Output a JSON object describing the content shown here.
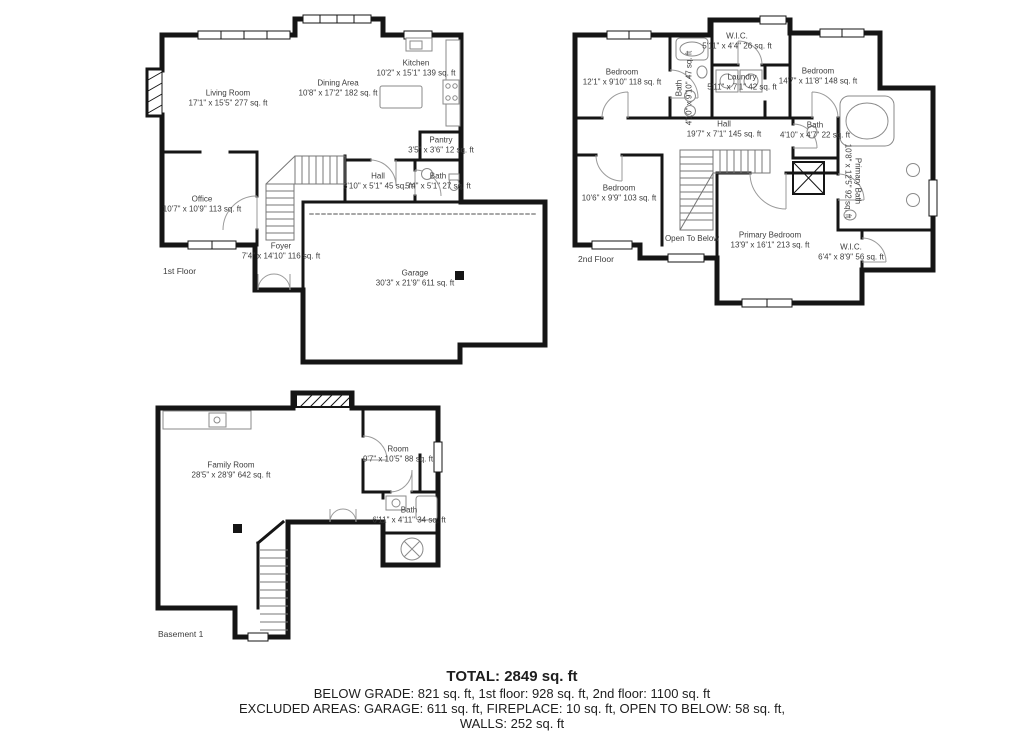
{
  "page": {
    "background": "#ffffff",
    "wall_color": "#151515",
    "label_color": "#3d3d3d"
  },
  "floors": [
    {
      "label": "1st Floor",
      "rooms": [
        {
          "name": "Living Room",
          "dims": "17'1\" x 15'5\" 277 sq. ft"
        },
        {
          "name": "Dining Area",
          "dims": "10'8\" x 17'2\" 182 sq. ft"
        },
        {
          "name": "Kitchen",
          "dims": "10'2\" x 15'1\" 139 sq. ft"
        },
        {
          "name": "Pantry",
          "dims": "3'5\" x 3'6\" 12 sq. ft"
        },
        {
          "name": "Hall",
          "dims": "8'10\" x 5'1\" 45 sq. ft"
        },
        {
          "name": "Bath",
          "dims": "5'4\" x 5'1\" 27 sq. ft"
        },
        {
          "name": "Office",
          "dims": "10'7\" x 10'9\" 113 sq. ft"
        },
        {
          "name": "Foyer",
          "dims": "7'4\" x 14'10\" 116 sq. ft"
        },
        {
          "name": "Garage",
          "dims": "30'3\" x 21'9\" 611 sq. ft"
        }
      ]
    },
    {
      "label": "2nd Floor",
      "rooms": [
        {
          "name": "Bedroom",
          "dims": "12'1\" x 9'10\" 118 sq. ft"
        },
        {
          "name": "W.I.C.",
          "dims": "5'11\" x 4'4\" 26 sq. ft"
        },
        {
          "name": "Laundry",
          "dims": "5'11\" x 7'1\" 42 sq. ft"
        },
        {
          "name": "Bedroom",
          "dims": "14'7\" x 11'8\" 148 sq. ft"
        },
        {
          "name": "Bath",
          "dims": "4'10\" x 9'10\" 47 sq. ft"
        },
        {
          "name": "Hall",
          "dims": "19'7\" x 7'1\" 145 sq. ft"
        },
        {
          "name": "Bath",
          "dims": "4'10\" x 4'7\" 22 sq. ft"
        },
        {
          "name": "Primary Bath",
          "dims": "10'8\" x 12'5\" 92 sq. ft"
        },
        {
          "name": "Bedroom",
          "dims": "10'6\" x 9'9\" 103 sq. ft"
        },
        {
          "name": "Open To Below",
          "dims": ""
        },
        {
          "name": "Primary Bedroom",
          "dims": "13'9\" x 16'1\" 213 sq. ft"
        },
        {
          "name": "W.I.C.",
          "dims": "6'4\" x 8'9\" 56 sq. ft"
        }
      ]
    },
    {
      "label": "Basement 1",
      "rooms": [
        {
          "name": "Family Room",
          "dims": "28'5\" x 28'9\" 642 sq. ft"
        },
        {
          "name": "Room",
          "dims": "9'7\" x 10'5\" 88 sq. ft"
        },
        {
          "name": "Bath",
          "dims": "6'11\" x 4'11\" 34 sq. ft"
        }
      ]
    }
  ],
  "summary": {
    "total": "TOTAL: 2849 sq. ft",
    "line1": "BELOW GRADE: 821 sq. ft, 1st floor: 928 sq. ft, 2nd floor: 1100 sq. ft",
    "line2": "EXCLUDED AREAS: GARAGE: 611 sq. ft, FIREPLACE: 10 sq. ft, OPEN TO BELOW: 58 sq. ft,",
    "line3": "WALLS: 252 sq. ft"
  }
}
